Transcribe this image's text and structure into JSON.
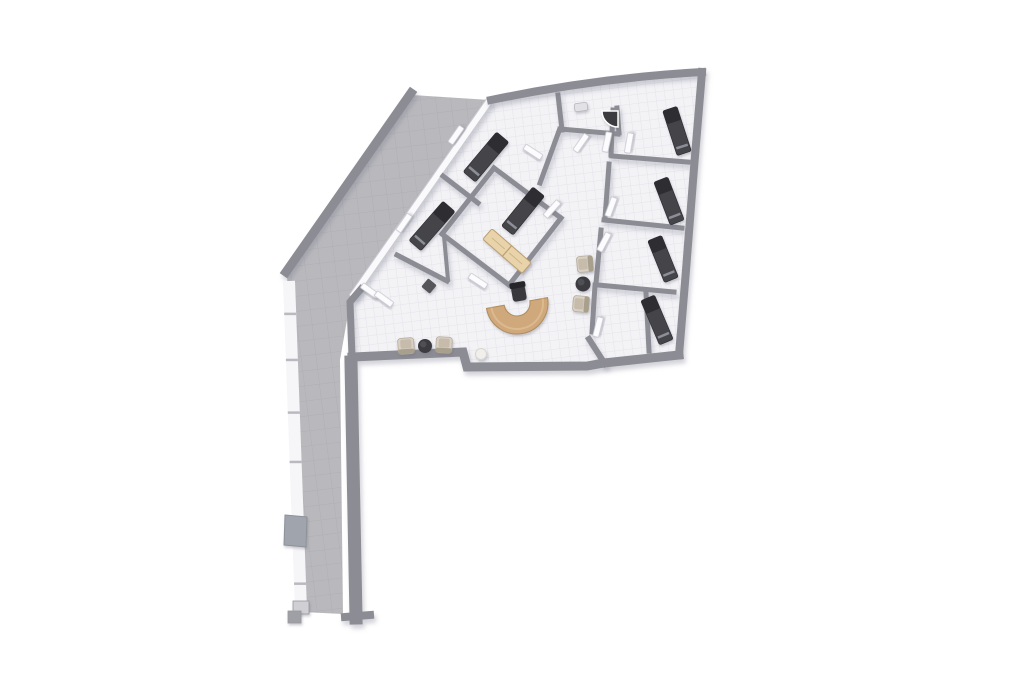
{
  "canvas": {
    "width": 1024,
    "height": 683,
    "background": "#ffffff"
  },
  "palette": {
    "wall": "#8c8c94",
    "wall_light": "#c9c9cf",
    "white_wall": "#fafafc",
    "terrace": "#b9b9bd",
    "terrace_line": "#aeaeb4",
    "floor": "#f3f3f6",
    "floor_line": "#e3e3ea",
    "bed_body": "#44444a",
    "bed_head": "#2d2d32",
    "bed_stripe": "#9fa1ab",
    "desk": "#cfa87c",
    "desk_edge": "#b08c5e",
    "bench": "#e8d3ab",
    "bench_edge": "#bb9e6f",
    "armchair": "#d9d1c4",
    "armchair_seat": "#c7bcab",
    "armchair_back": "#a99f8d",
    "table": "#3b3b40",
    "office_chair": "#37373c",
    "door": "#fcfcfe",
    "door_edge": "#c6c6ce",
    "shower": "#3a3a3f",
    "sphere": "#f1efec",
    "sphere_edge": "#d9d6d1",
    "bin": "#54545a",
    "window": "#f6f6f8",
    "mullion": "#b9b9bf",
    "chimney": "#a0a5ad",
    "stub_light": "#cfcfd4",
    "stub_dark": "#9fa0a6",
    "sink": "#e2e2e6",
    "sink_edge": "#b5b5bb"
  },
  "floors": {
    "terrace": {
      "points": [
        [
          412,
          95
        ],
        [
          490,
          100
        ],
        [
          351,
          297
        ],
        [
          340,
          360
        ],
        [
          343,
          614
        ],
        [
          302,
          612
        ],
        [
          299,
          480
        ],
        [
          293,
          370
        ],
        [
          287,
          276
        ]
      ]
    },
    "interior": {
      "points": [
        [
          491,
          101
        ],
        [
          596,
          84
        ],
        [
          701,
          73
        ],
        [
          694,
          168
        ],
        [
          686,
          270
        ],
        [
          679,
          354
        ],
        [
          604,
          362
        ],
        [
          587,
          365
        ],
        [
          467,
          365
        ],
        [
          463,
          350
        ],
        [
          353,
          356
        ],
        [
          351,
          301
        ],
        [
          362,
          289
        ]
      ]
    }
  },
  "walls": {
    "outer": [
      {
        "d": "M491,100 Q596,78 702,72",
        "w": 8
      },
      {
        "d": "M702,72 L694,168 L686,270 L679,355",
        "w": 8
      },
      {
        "d": "M679,355 L604,363 L587,366 L467,367 L463,352 L352,357",
        "w": 9
      },
      {
        "d": "M352,357 L350,302 L361,289",
        "w": 7
      },
      {
        "d": "M351,362 L356,618",
        "w": 13
      },
      {
        "d": "M345,617 L370,615",
        "w": 8
      }
    ],
    "inner": [
      {
        "d": "M443,176 L478,203",
        "w": 5
      },
      {
        "d": "M494,168 L561,218",
        "w": 5
      },
      {
        "d": "M561,218 L509,285",
        "w": 5
      },
      {
        "d": "M509,285 L442,234",
        "w": 5
      },
      {
        "d": "M442,234 L494,168",
        "w": 5
      },
      {
        "d": "M397,255 L447,281",
        "w": 5
      },
      {
        "d": "M444,236 L448,280",
        "w": 4
      },
      {
        "d": "M540,183 L559,131",
        "w": 5
      },
      {
        "d": "M558,95 L562,130",
        "w": 5
      },
      {
        "d": "M560,129 L618,134",
        "w": 5
      },
      {
        "d": "M617,108 L619,133",
        "w": 5
      },
      {
        "d": "M613,110 L611,155",
        "w": 5
      },
      {
        "d": "M612,156 L688,162",
        "w": 5
      },
      {
        "d": "M609,164 L605,218",
        "w": 5
      },
      {
        "d": "M604,220 L682,228",
        "w": 5
      },
      {
        "d": "M601,230 L596,283",
        "w": 5
      },
      {
        "d": "M598,285 L674,292",
        "w": 5
      },
      {
        "d": "M595,285 L592,332",
        "w": 5
      },
      {
        "d": "M646,293 L649,351",
        "w": 5
      },
      {
        "d": "M589,339 L605,364",
        "w": 6
      }
    ],
    "white_wall": {
      "d": "M490,100 L352,297",
      "w_outer": 8,
      "w_inner": 6
    },
    "parapet": {
      "d": "M411,93 L286,272",
      "w": 9
    }
  },
  "windows": {
    "band": {
      "x1": 289,
      "y1": 281,
      "x2": 301,
      "y2": 610,
      "w": 12
    },
    "mullion_fracs": [
      0.1,
      0.24,
      0.4,
      0.55,
      0.78,
      0.92
    ],
    "chimney": [
      [
        285,
        515
      ],
      [
        307,
        517
      ],
      [
        306,
        547
      ],
      [
        284,
        545
      ]
    ],
    "stubs": [
      {
        "x": 293,
        "y": 601,
        "w": 16,
        "h": 13,
        "tone": "light"
      },
      {
        "x": 288,
        "y": 611,
        "w": 13,
        "h": 12,
        "tone": "dark"
      }
    ]
  },
  "doors": [
    {
      "cx": 581,
      "cy": 143,
      "rot": -55
    },
    {
      "cx": 607,
      "cy": 142,
      "rot": -78
    },
    {
      "cx": 629,
      "cy": 143,
      "rot": -80
    },
    {
      "cx": 611,
      "cy": 207,
      "rot": -70
    },
    {
      "cx": 604,
      "cy": 242,
      "rot": -62
    },
    {
      "cx": 598,
      "cy": 327,
      "rot": -76
    },
    {
      "cx": 552,
      "cy": 209,
      "rot": -48
    },
    {
      "cx": 370,
      "cy": 291,
      "rot": 36
    },
    {
      "cx": 384,
      "cy": 299,
      "rot": 36
    },
    {
      "cx": 404,
      "cy": 223,
      "rot": -55
    },
    {
      "cx": 456,
      "cy": 135,
      "rot": -55
    },
    {
      "cx": 533,
      "cy": 152,
      "rot": 33
    },
    {
      "cx": 478,
      "cy": 281,
      "rot": 33
    }
  ],
  "furniture": {
    "beds": [
      {
        "cx": 486,
        "cy": 157,
        "rot": -50,
        "len": 52,
        "wid": 16,
        "head": 1
      },
      {
        "cx": 432,
        "cy": 226,
        "rot": -49,
        "len": 52,
        "wid": 16,
        "head": 1
      },
      {
        "cx": 523,
        "cy": 211,
        "rot": -51,
        "len": 50,
        "wid": 15,
        "head": 1
      },
      {
        "cx": 677,
        "cy": 131,
        "rot": 72,
        "len": 47,
        "wid": 15,
        "head": -1
      },
      {
        "cx": 669,
        "cy": 201,
        "rot": 69,
        "len": 46,
        "wid": 15,
        "head": -1
      },
      {
        "cx": 663,
        "cy": 259,
        "rot": 68,
        "len": 45,
        "wid": 15,
        "head": -1
      },
      {
        "cx": 657,
        "cy": 320,
        "rot": 67,
        "len": 48,
        "wid": 15,
        "head": -1
      }
    ],
    "bench": {
      "cx": 507,
      "cy": 251,
      "rot": 41,
      "len": 52,
      "wid": 14
    },
    "desk": {
      "cx": 517,
      "cy": 303,
      "r_outer": 31,
      "r_inner": 13,
      "rot": -10
    },
    "office_chair": {
      "cx": 519,
      "cy": 294,
      "rot": -10
    },
    "armchairs": [
      {
        "cx": 585,
        "cy": 264,
        "rot": -95,
        "size": 16
      },
      {
        "cx": 581,
        "cy": 304,
        "rot": -85,
        "size": 16
      },
      {
        "cx": 406,
        "cy": 346,
        "rot": -4,
        "size": 16
      },
      {
        "cx": 444,
        "cy": 345,
        "rot": 3,
        "size": 16
      }
    ],
    "coffee_tables": [
      {
        "cx": 583,
        "cy": 284,
        "r": 7.5
      },
      {
        "cx": 425,
        "cy": 346,
        "r": 7
      }
    ],
    "sphere": {
      "cx": 481,
      "cy": 354,
      "r": 5.5
    },
    "bin": {
      "cx": 429,
      "cy": 286,
      "size": 11,
      "rot": 40
    },
    "shower": {
      "corner_x": 618,
      "corner_y": 111,
      "r": 16
    },
    "sink": {
      "cx": 581,
      "cy": 107,
      "w": 13,
      "h": 8,
      "rot": -8
    }
  }
}
